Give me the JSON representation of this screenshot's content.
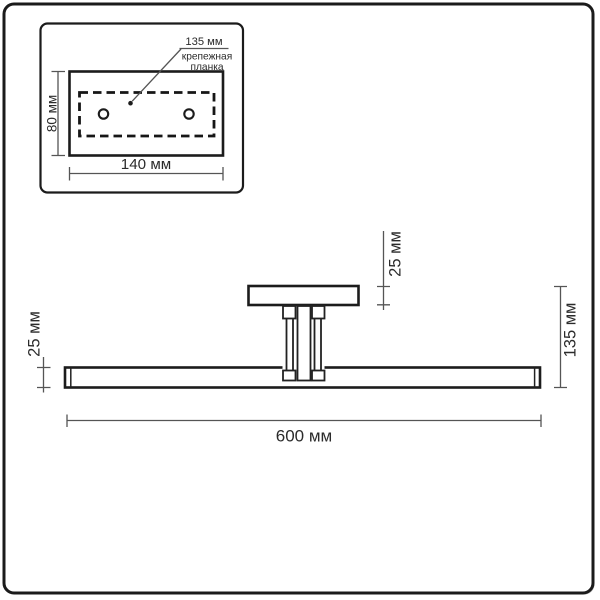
{
  "page": {
    "background": "#ffffff"
  },
  "colors": {
    "object_line": "#1c1c1c",
    "dimension_line": "#555555",
    "text": "#2b2b2b",
    "frame_border": "#1b1b1b",
    "frame_shadow": "#c9c9c9"
  },
  "detail_panel": {
    "hole_spacing_label": "135 мм",
    "bracket_name_line1": "крепежная",
    "bracket_name_line2": "планка",
    "plate_height_label": "80 мм",
    "plate_width_label": "140 мм"
  },
  "main_view": {
    "bar_height_label": "25 мм",
    "canopy_height_label": "25 мм",
    "overall_height_label": "135 мм",
    "overall_width_label": "600 мм"
  }
}
